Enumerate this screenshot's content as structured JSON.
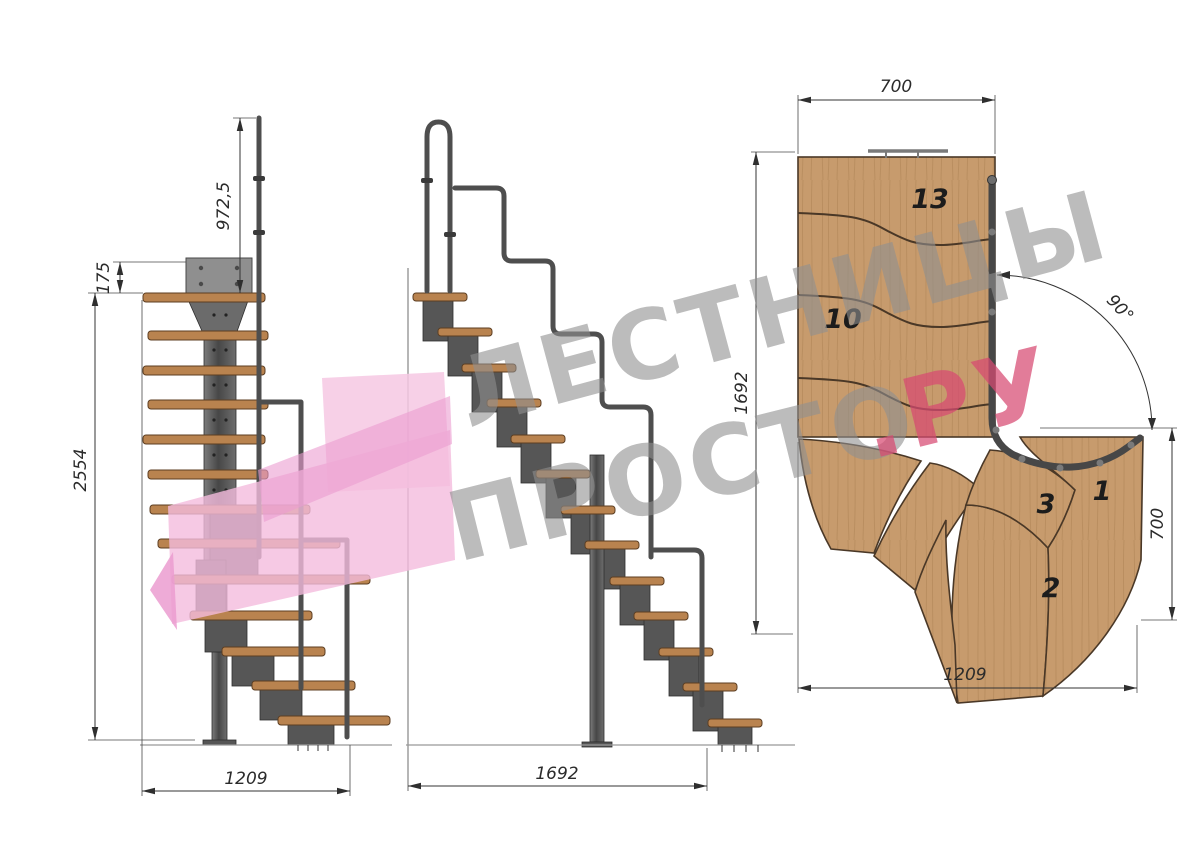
{
  "drawing": {
    "views": {
      "front": {
        "name": "front-elevation"
      },
      "side": {
        "name": "side-elevation"
      },
      "plan": {
        "name": "top-plan"
      }
    },
    "dimensions": {
      "front_rail_height": "972,5",
      "front_top_offset": "175",
      "front_total_height": "2554",
      "front_width": "1209",
      "side_length": "1692",
      "plan_top_width": "700",
      "plan_depth": "1692",
      "plan_exit_width": "700",
      "plan_bottom_width": "1209",
      "plan_turn_angle": "90°"
    },
    "plan_step_labels": {
      "top": "13",
      "middle": "10",
      "winder3": "3",
      "winder1": "1",
      "winder2": "2"
    }
  },
  "watermark": {
    "line1": "ЛЕСТНИЦЫ",
    "line2_main": "ПРОСТО",
    "line2_accent": ".РУ"
  },
  "colors": {
    "tread_wood": "#b9834f",
    "plan_wood": "#c79b6d",
    "steel_dark": "#4e4e4e",
    "steel_mid": "#6a6a6a",
    "watermark_gray": "#909090",
    "watermark_pink": "#d84a72",
    "logo_pink_light": "#f6c8e3",
    "logo_pink_mid": "#f4bcdd",
    "logo_pink_deep": "#eb9cd0"
  }
}
